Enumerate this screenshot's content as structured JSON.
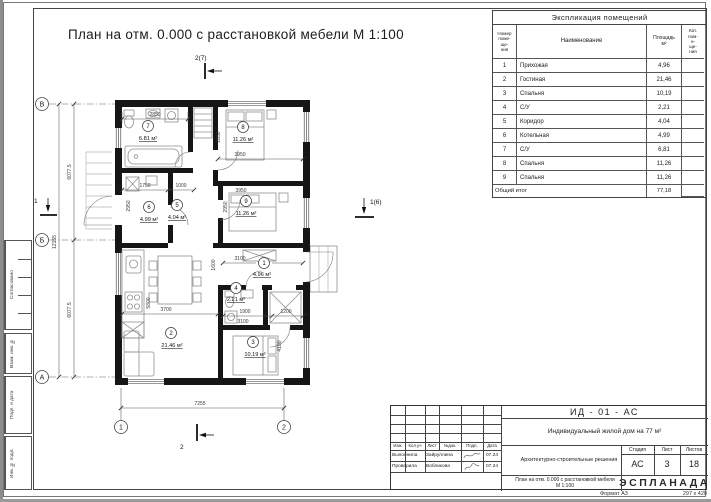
{
  "sheet": {
    "title": "План на отм. 0.000 с расстановкой мебели М 1:100",
    "format_label": "Формат А3",
    "format_size": "297 х 420"
  },
  "margin_fields": {
    "f1": "Согласовано",
    "f2": "Взам. инв. №",
    "f3": "Подп. и дата",
    "f4": "Инв. № подл."
  },
  "axes": {
    "left": [
      "В",
      "Б",
      "А"
    ],
    "bottom": [
      "1",
      "2"
    ]
  },
  "markers": {
    "top": "2(7)",
    "right": "1(6)",
    "left": "1",
    "bottom": "2"
  },
  "dims": {
    "room7_top": "2850",
    "room8_left": "2850",
    "room8_bottom": "3950",
    "room9_top": "3950",
    "room6_left": "2950",
    "room9_left": "2950",
    "corridor_a": "1750",
    "corridor_b": "1000",
    "hall_width": "3100",
    "hall_height": "1600",
    "living_width": "3700",
    "living_height": "5800",
    "wc_width": "1900",
    "closet_width": "1200",
    "bedroom3_width": "3100",
    "bedroom3_height": "4100",
    "bottom_overall": "7255",
    "left_overall": "12155",
    "left_top": "6077.5",
    "left_bottom": "6077.5"
  },
  "rooms": {
    "r1": {
      "num": "1",
      "area": "4.96 м²"
    },
    "r2": {
      "num": "2",
      "area": "21.46 м²"
    },
    "r3": {
      "num": "3",
      "area": "10.19 м²"
    },
    "r4": {
      "num": "4",
      "area": "2.21 м²"
    },
    "r5": {
      "num": "5",
      "area": "4.04 м²"
    },
    "r6": {
      "num": "6",
      "area": "4.99 м²"
    },
    "r7": {
      "num": "7",
      "area": "6.81 м²"
    },
    "r8": {
      "num": "8",
      "area": "11.26 м²"
    },
    "r9": {
      "num": "9",
      "area": "11.26 м²"
    }
  },
  "schedule": {
    "title": "Экспликация помещений",
    "headers": {
      "num": "Номер\nпоме-\nще-\nния",
      "name": "Наименование",
      "area": "Площадь\nм²",
      "cat": "Кат.\nпом-\nе-\nще-\nния"
    },
    "rows": [
      {
        "num": "1",
        "name": "Прихожая",
        "area": "4,96"
      },
      {
        "num": "2",
        "name": "Гостиная",
        "area": "21,46"
      },
      {
        "num": "3",
        "name": "Спальня",
        "area": "10,19"
      },
      {
        "num": "4",
        "name": "С/У",
        "area": "2,21"
      },
      {
        "num": "5",
        "name": "Коридор",
        "area": "4,04"
      },
      {
        "num": "6",
        "name": "Котельная",
        "area": "4,99"
      },
      {
        "num": "7",
        "name": "С/У",
        "area": "6,81"
      },
      {
        "num": "8",
        "name": "Спальня",
        "area": "11,26"
      },
      {
        "num": "9",
        "name": "Спальня",
        "area": "11,26"
      }
    ],
    "total_label": "Общий итог",
    "total_value": "77,18"
  },
  "titleblock": {
    "doc_code": "ИД - 01 - АС",
    "object_name": "Индивидуальный жилой дом на 77 м²",
    "section_name": "Архитектурно-строительные решения",
    "sheet_name": "План на отм. 0.000 с расстановкой мебели\nМ 1:100",
    "stage_label": "Стадия",
    "sheet_label": "Лист",
    "sheets_label": "Листов",
    "stage": "АС",
    "sheet": "3",
    "sheets": "18",
    "cols": [
      "Изм.",
      "Кол.уч",
      "Лист",
      "№док.",
      "Подп.",
      "Дата"
    ],
    "row1_role": "Выполнила",
    "row1_name": "Зайруллина",
    "row1_date": "07.24",
    "row2_role": "Проверила",
    "row2_name": "Вобликова",
    "row2_date": "07.24",
    "logo": "ЭСПЛАНАДА"
  }
}
